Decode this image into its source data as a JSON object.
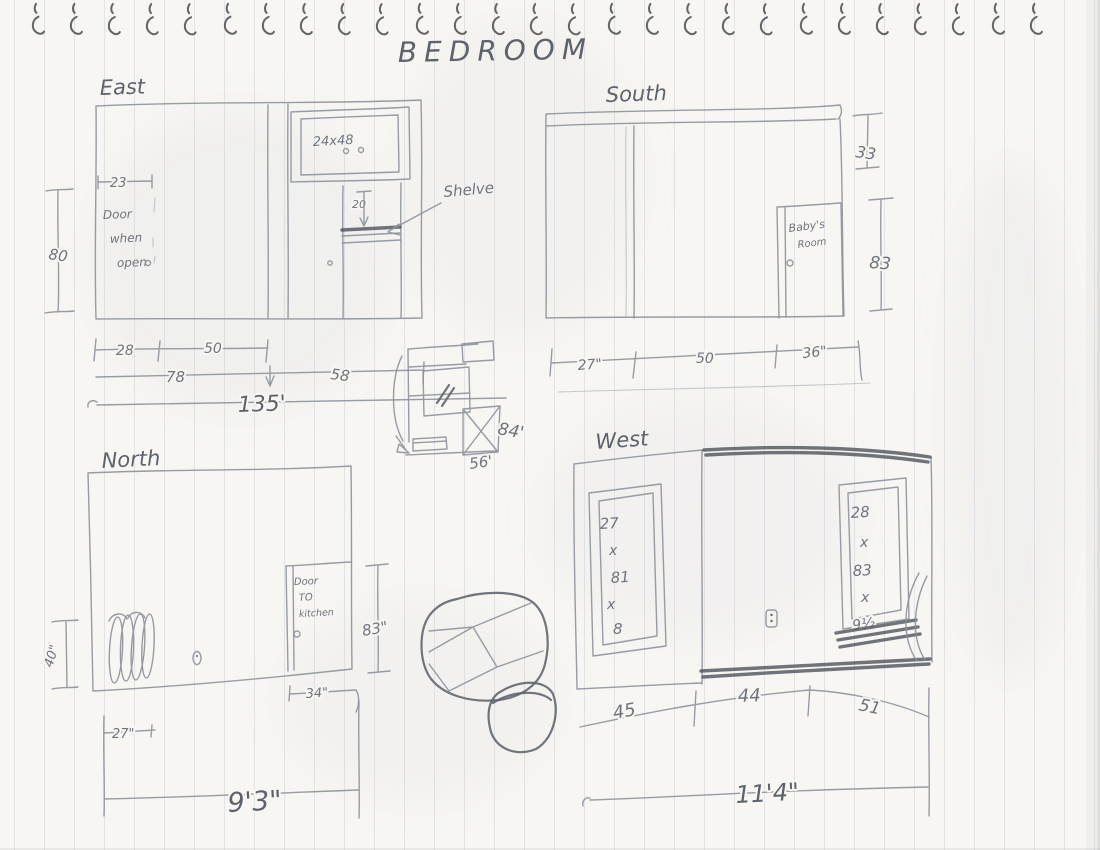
{
  "title": "BEDROOM",
  "east": {
    "label": "East",
    "cabinet": "24x48",
    "shelf_note": "Shelve",
    "shelf_dim": "20",
    "door_width_dim": "23",
    "height_dim": "80",
    "door_note": [
      "Door",
      "when",
      "open"
    ],
    "dims_row1": [
      "28",
      "50"
    ],
    "dims_row2": [
      "78",
      "58"
    ],
    "dims_total": "135'"
  },
  "south": {
    "label": "South",
    "door_note": [
      "Baby's",
      "Room"
    ],
    "upper_dim": "33",
    "door_height_dim": "83",
    "dims": [
      "27\"",
      "50",
      "36\""
    ]
  },
  "north": {
    "label": "North",
    "door_note": [
      "Door",
      "TO",
      "kitchen"
    ],
    "radiator_dim": "40\"",
    "height_dim": "83\"",
    "door_dim": "34\"",
    "offset_dim": "27\"",
    "dims_total": "9'3\""
  },
  "west": {
    "label": "West",
    "left_mirror_dims": [
      "27",
      "x",
      "81",
      "x",
      "8"
    ],
    "right_mirror_dims": [
      "28",
      "x",
      "83",
      "x",
      "9½"
    ],
    "dims": [
      "45",
      "44",
      "51"
    ],
    "dims_total": "11'4\""
  },
  "closet_plan": {
    "depth_dim": "84'",
    "width_dim": "56'"
  },
  "colors": {
    "pencil": "#8d919a",
    "pencil_dark": "#4e525a",
    "paper": "#f7f6f3",
    "rule_line": "#97a3b4"
  }
}
